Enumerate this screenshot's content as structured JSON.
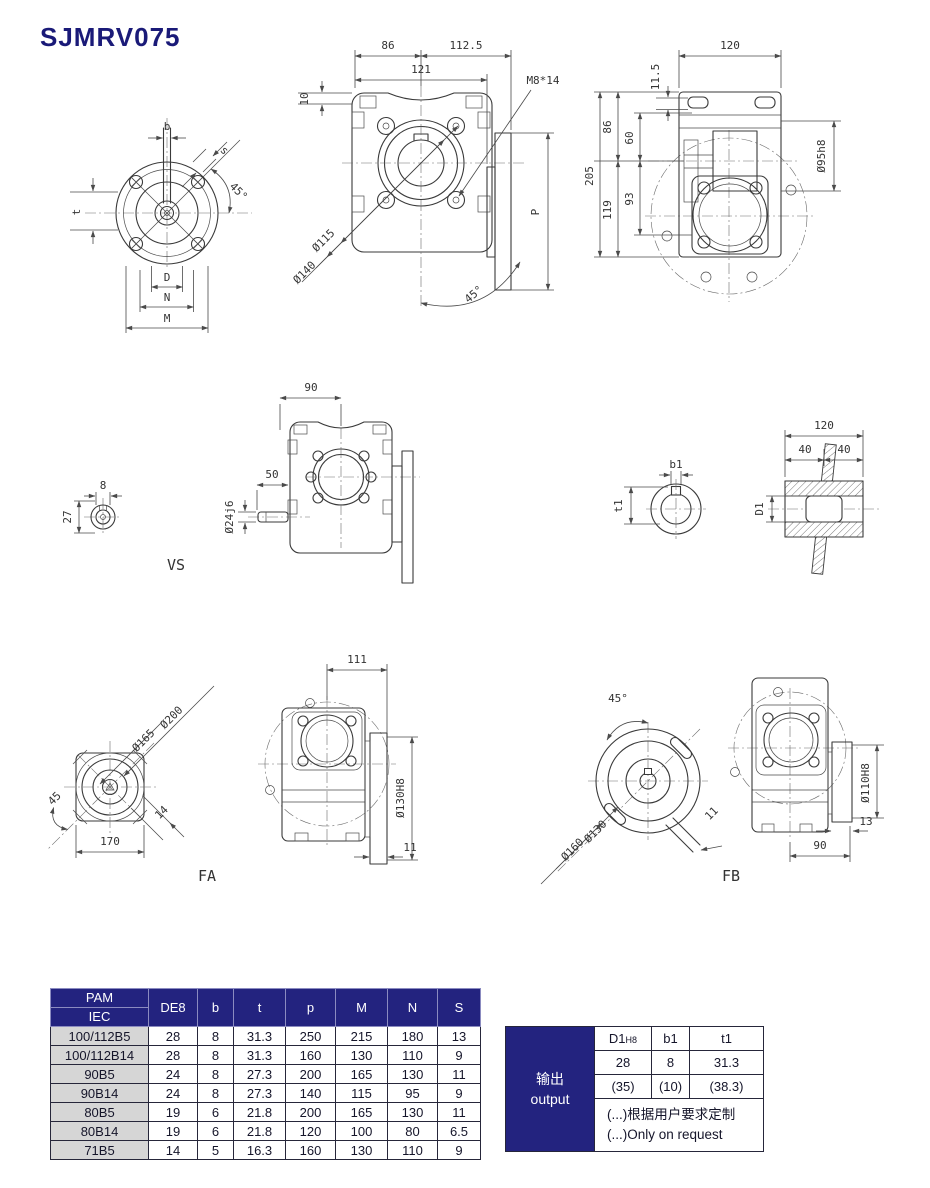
{
  "page": {
    "title": "SJMRV075"
  },
  "colors": {
    "navy": "#23237f",
    "title_blue": "#1a1a78",
    "row_gray": "#d6d6d6",
    "line": "#3a3a3a"
  },
  "views": {
    "flange": {
      "b": "b",
      "s": "s",
      "angle45": "45°",
      "t": "t",
      "D": "D",
      "N": "N",
      "M": "M"
    },
    "front": {
      "d86": "86",
      "d112_5": "112.5",
      "d121": "121",
      "m8": "M8*14",
      "d10": "10",
      "d115": "Ø115",
      "d140": "Ø140",
      "angle45": "45°",
      "P": "P"
    },
    "side": {
      "d120": "120",
      "d11_5": "11.5",
      "d86": "86",
      "d60": "60",
      "d205": "205",
      "d119": "119",
      "d93": "93",
      "d95h8": "Ø95h8"
    },
    "vs": {
      "d8": "8",
      "d27": "27",
      "label": "VS"
    },
    "mid": {
      "d90": "90",
      "d50": "50",
      "d24j6": "Ø24j6"
    },
    "key": {
      "b1": "b1",
      "t1": "t1"
    },
    "hollow": {
      "d120": "120",
      "d40a": "40",
      "d40b": "40",
      "D1": "D1"
    },
    "fa": {
      "d200": "Ø200",
      "d165": "Ø165",
      "d45": "45",
      "d14": "14",
      "d170": "170",
      "label": "FA",
      "d111": "111",
      "d130h8": "Ø130H8",
      "d11": "11"
    },
    "fb": {
      "angle45": "45°",
      "d130": "Ø130",
      "d160": "Ø160",
      "d11": "11",
      "label": "FB",
      "d110h8": "Ø110H8",
      "d13": "13",
      "d90": "90"
    }
  },
  "pam_table": {
    "corner_top": "PAM",
    "corner_bottom": "IEC",
    "columns": [
      "DE8",
      "b",
      "t",
      "p",
      "M",
      "N",
      "S"
    ],
    "rows": [
      {
        "label": "100/112B5",
        "values": [
          "28",
          "8",
          "31.3",
          "250",
          "215",
          "180",
          "13"
        ]
      },
      {
        "label": "100/112B14",
        "values": [
          "28",
          "8",
          "31.3",
          "160",
          "130",
          "110",
          "9"
        ]
      },
      {
        "label": "90B5",
        "values": [
          "24",
          "8",
          "27.3",
          "200",
          "165",
          "130",
          "11"
        ]
      },
      {
        "label": "90B14",
        "values": [
          "24",
          "8",
          "27.3",
          "140",
          "115",
          "95",
          "9"
        ]
      },
      {
        "label": "80B5",
        "values": [
          "19",
          "6",
          "21.8",
          "200",
          "165",
          "130",
          "11"
        ]
      },
      {
        "label": "80B14",
        "values": [
          "19",
          "6",
          "21.8",
          "120",
          "100",
          "80",
          "6.5"
        ]
      },
      {
        "label": "71B5",
        "values": [
          "14",
          "5",
          "16.3",
          "160",
          "130",
          "110",
          "9"
        ]
      }
    ]
  },
  "output_table": {
    "side_cn": "输出",
    "side_en": "output",
    "col_d1": "D1",
    "col_d1_sub": "H8",
    "col_b1": "b1",
    "col_t1": "t1",
    "row1": [
      "28",
      "8",
      "31.3"
    ],
    "row2": [
      "(35)",
      "(10)",
      "(38.3)"
    ],
    "note_cn": "(...)根据用户要求定制",
    "note_en": "(...)Only on request"
  }
}
